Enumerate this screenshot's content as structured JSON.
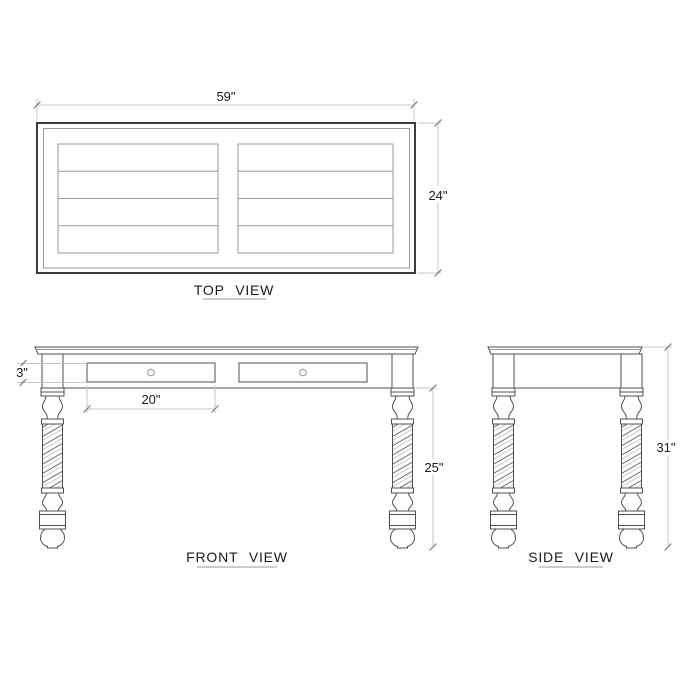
{
  "drawing_title": "desk three-view technical drawing",
  "top_view": {
    "label": "TOP VIEW",
    "width_dim": "59\"",
    "depth_dim": "24\""
  },
  "front_view": {
    "label": "FRONT VIEW",
    "apron_height_dim": "3\"",
    "drawer_width_dim": "20\"",
    "leg_height_dim": "25\"",
    "drawer_count": 2,
    "knob_shape": "circle"
  },
  "side_view": {
    "label": "SIDE VIEW",
    "total_height_dim": "31\""
  },
  "legs": {
    "style": "barley-twist turned legs",
    "count_per_view": 2
  },
  "colors": {
    "background": "#ffffff",
    "outline": "#4f4f4f",
    "outline_dark": "#3c3c3c",
    "panel_line": "#9a9a9a",
    "dim_line": "#c6c6c6",
    "tick": "#7f7f7f",
    "text": "#1a1a1a",
    "underline": "#9a9a9a",
    "knob": "#909090",
    "twist_line": "#6f6f6f"
  }
}
